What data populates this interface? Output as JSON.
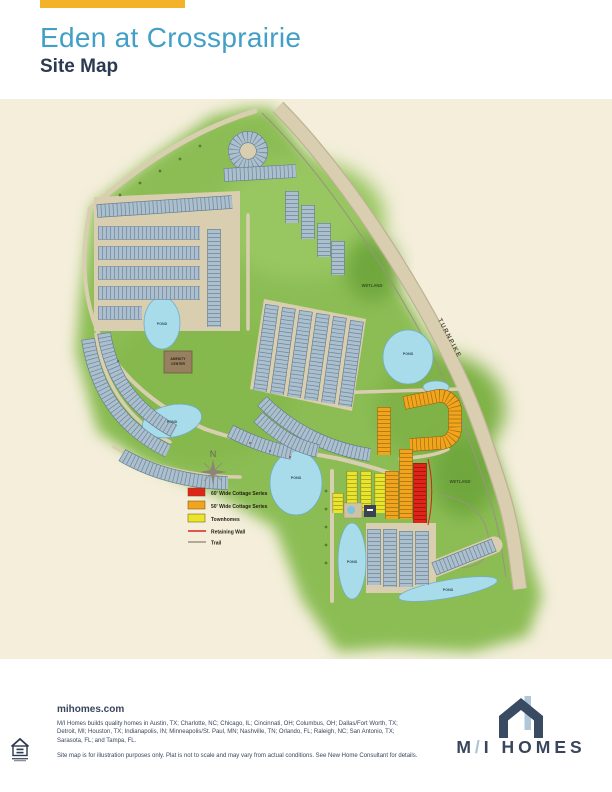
{
  "header": {
    "title": "Eden at Crossprairie",
    "subtitle": "Site Map",
    "accent_color": "#F2B32A",
    "title_color": "#429FC6",
    "subtitle_color": "#2B3A52"
  },
  "map": {
    "labels": {
      "turnpike": "TURNPIKE",
      "pond": "POND",
      "wetland": "WETLAND",
      "amenity_line1": "AMENITY",
      "amenity_line2": "CENTER",
      "compass_north": "N"
    },
    "legend": {
      "items": [
        {
          "label": "60' Wide Cottage Series",
          "color": "#E0241A",
          "style": "swatch"
        },
        {
          "label": "50' Wide Cottage Series",
          "color": "#F2A41D",
          "style": "swatch"
        },
        {
          "label": "Townhomes",
          "color": "#E9E52C",
          "style": "swatch"
        },
        {
          "label": "Retaining Wall",
          "color": "#E0241A",
          "style": "line"
        },
        {
          "label": "Trail",
          "color": "#9A947F",
          "style": "line"
        }
      ]
    },
    "colors": {
      "land": "#8CBD55",
      "lots": "#ABBFCE",
      "water": "#A9DCEB",
      "road": "#D9CEAF",
      "wetland": "#6FA73C"
    }
  },
  "footer": {
    "website": "mihomes.com",
    "markets": "M/I Homes builds quality homes in Austin, TX; Charlotte, NC; Chicago, IL; Cincinnati, OH; Columbus, OH; Dallas/Fort Worth, TX; Detroit, MI; Houston, TX; Indianapolis, IN; Minneapolis/St. Paul, MN; Nashville, TN; Orlando, FL; Raleigh, NC; San Antonio, TX; Sarasota, FL; and Tampa, FL.",
    "note": "Site map is for illustration purposes only. Plat is not to scale and may vary from actual conditions. See New Home Consultant for details.",
    "logo_m": "M",
    "logo_slash": "/",
    "logo_rest": "I HOMES"
  }
}
